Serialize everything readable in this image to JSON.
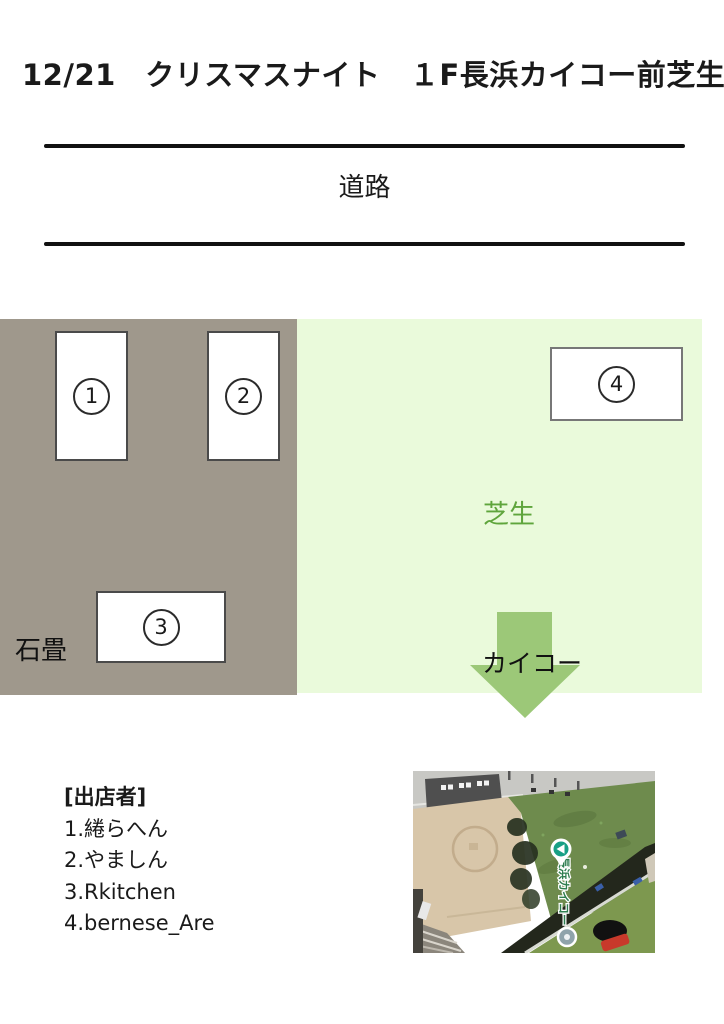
{
  "title": "12/21　クリスマスナイト　１F長浜カイコー前芝生",
  "road": {
    "label": "道路"
  },
  "map": {
    "stone_zone_label": "石畳",
    "lawn_zone_label": "芝生",
    "kaiko_arrow_label": "カイコー",
    "booths": [
      {
        "number": "1"
      },
      {
        "number": "2"
      },
      {
        "number": "3"
      },
      {
        "number": "4"
      }
    ],
    "colors": {
      "stone_zone": "#9f988c",
      "lawn_zone": "#eafadb",
      "arrow_green": "#9cc878",
      "lawn_label_green": "#5fa53c",
      "text_black": "#1a1a1a"
    }
  },
  "vendors": {
    "heading": "[出店者]",
    "items": [
      "1.綣らへん",
      "2.やましん",
      "3.Rkitchen",
      "4.bernese_Are"
    ]
  },
  "aerial_photo": {
    "pin_label": "長浜カイコー"
  }
}
